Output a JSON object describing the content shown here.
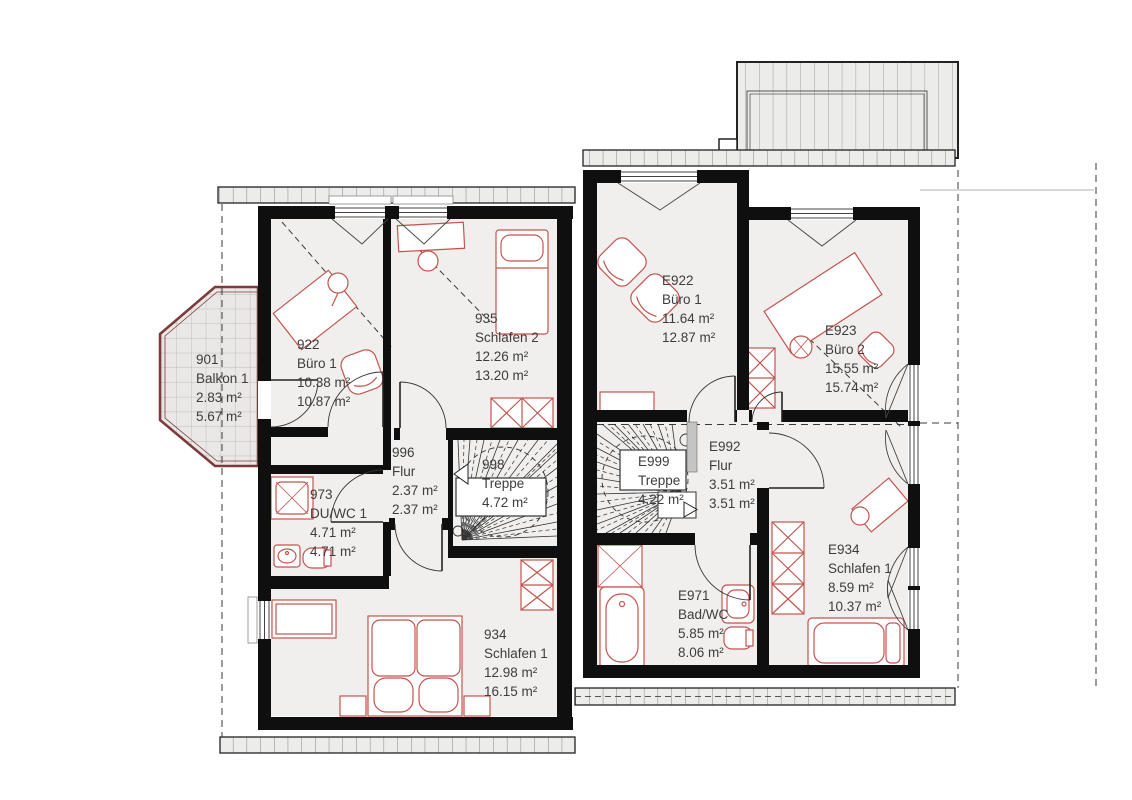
{
  "plan": {
    "type": "architectural-floor-plan",
    "language": "de",
    "colors": {
      "wall": "#0f0f0f",
      "floor": "#f0efee",
      "furniture_accent": "#c4544e",
      "balcony_border": "#7b3b3b",
      "text": "#3d3d3d"
    },
    "rooms": [
      {
        "id": "901",
        "name": "Balkon 1",
        "area1": "2.83 m²",
        "area2": "5.67 m²"
      },
      {
        "id": "922",
        "name": "Büro 1",
        "area1": "10.38 m²",
        "area2": "10.87 m²"
      },
      {
        "id": "935",
        "name": "Schlafen 2",
        "area1": "12.26 m²",
        "area2": "13.20 m²"
      },
      {
        "id": "996",
        "name": "Flur",
        "area1": "2.37 m²",
        "area2": "2.37 m²"
      },
      {
        "id": "998",
        "name": "Treppe",
        "area1": "4.72 m²"
      },
      {
        "id": "973",
        "name": "DU/WC 1",
        "area1": "4.71 m²",
        "area2": "4.71 m²"
      },
      {
        "id": "934",
        "name": "Schlafen 1",
        "area1": "12.98 m²",
        "area2": "16.15 m²"
      },
      {
        "id": "E922",
        "name": "Büro 1",
        "area1": "11.64 m²",
        "area2": "12.87 m²"
      },
      {
        "id": "E923",
        "name": "Büro 2",
        "area1": "15.55 m²",
        "area2": "15.74 m²"
      },
      {
        "id": "E992",
        "name": "Flur",
        "area1": "3.51 m²",
        "area2": "3.51 m²"
      },
      {
        "id": "E999",
        "name": "Treppe",
        "area1": "4.22 m²"
      },
      {
        "id": "E971",
        "name": "Bad/WC",
        "area1": "5.85 m²",
        "area2": "8.06 m²"
      },
      {
        "id": "E934",
        "name": "Schlafen 1",
        "area1": "8.59 m²",
        "area2": "10.37 m²"
      }
    ]
  }
}
